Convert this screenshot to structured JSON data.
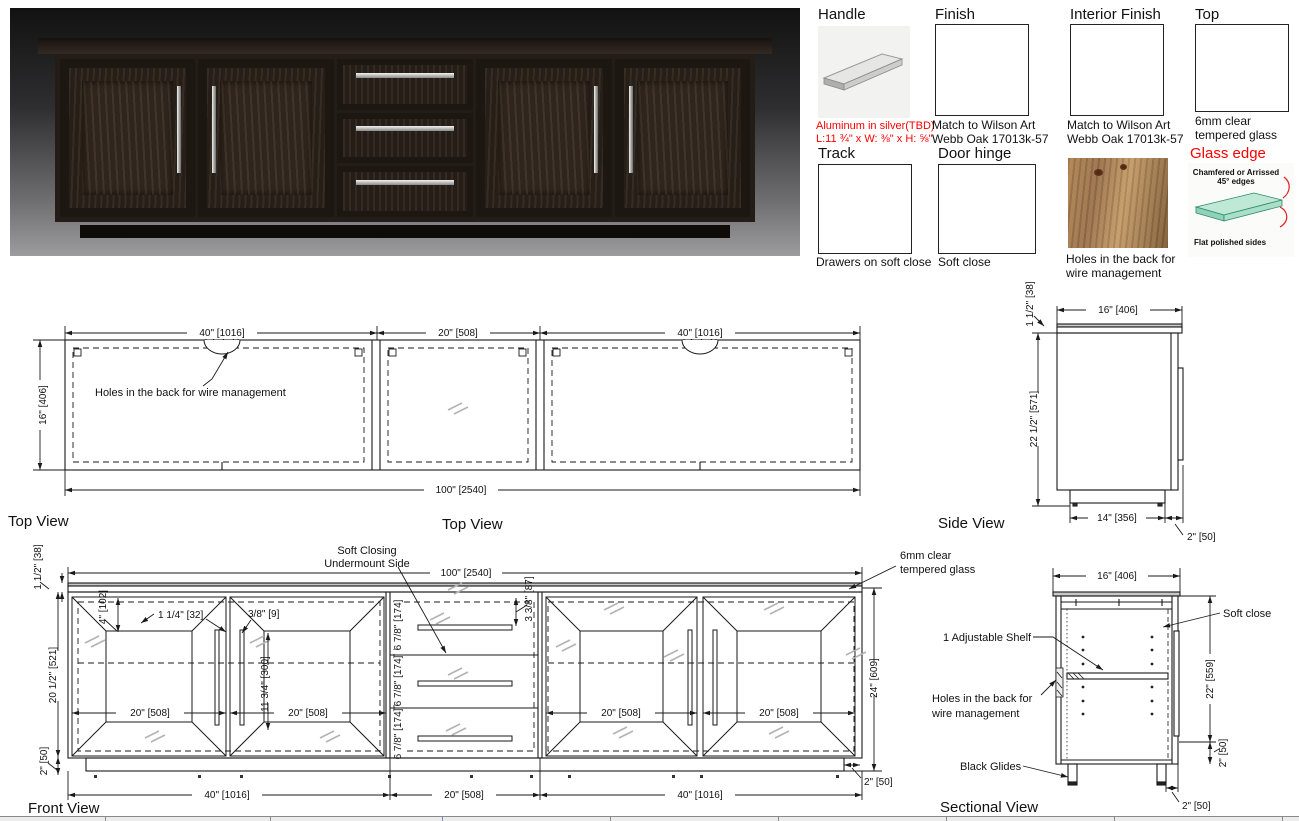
{
  "specs": {
    "handle": {
      "title": "Handle",
      "note1": "Aluminum in silver(TBD)",
      "note2": "L:11 ¾\" x W: ⅜\" x H: ⅝\""
    },
    "finish": {
      "title": "Finish",
      "note1": "Match to Wilson Art",
      "note2": "Webb Oak 17013k-57"
    },
    "interior_finish": {
      "title": "Interior Finish",
      "note1": "Match to Wilson Art",
      "note2": "Webb Oak 17013k-57"
    },
    "top": {
      "title": "Top",
      "note1": "6mm clear",
      "note2": "tempered glass"
    },
    "track": {
      "title": "Track",
      "note": "Drawers on soft close"
    },
    "door_hinge": {
      "title": "Door hinge",
      "note": "Soft close"
    },
    "wire_holes": {
      "note1": "Holes in the back for",
      "note2": "wire management"
    },
    "glass_edge": {
      "title": "Glass edge",
      "label1a": "Chamfered or Arrissed",
      "label1b": "45° edges",
      "label2": "Flat polished sides"
    }
  },
  "top_view": {
    "title_left": "Top View",
    "title_center": "Top View",
    "dim_w_left": "40\" [1016]",
    "dim_w_mid": "20\" [508]",
    "dim_w_right": "40\" [1016]",
    "dim_depth": "16\" [406]",
    "dim_total": "100\" [2540]",
    "note_holes": "Holes in the back for wire management"
  },
  "side_view": {
    "title": "Side View",
    "dim_width": "16\" [406]",
    "dim_top": "1 1/2\" [38]",
    "dim_height": "22 1/2\" [571]",
    "dim_base": "14\" [356]",
    "dim_offset": "2\" [50]"
  },
  "front_view": {
    "title": "Front View",
    "dim_total": "100\" [2540]",
    "dim_top_thickness": "1 1/2\" [38]",
    "dim_frame": "4\" [102]",
    "dim_stile": "1 1/4\" [32]",
    "dim_gap": "3/8\" [9]",
    "dim_panel_h": "11 3/4\" [300]",
    "dim_body_h": "20 1/2\" [521]",
    "dim_kick": "2\" [50]",
    "dim_door_w": "20\" [508]",
    "dim_drawer_h": "6 7/8\" [174]",
    "dim_top_drawer": "3 3/8\" [87]",
    "dim_height": "24\" [609]",
    "dim_kick_inset": "2\" [50]",
    "dim_bottom_left": "40\" [1016]",
    "dim_bottom_mid": "20\" [508]",
    "dim_bottom_right": "40\" [1016]",
    "note_soft1": "Soft Closing",
    "note_soft2": "Undermount Side",
    "note_glass1": "6mm clear",
    "note_glass2": "tempered glass"
  },
  "sectional_view": {
    "title": "Sectional View",
    "dim_width": "16\" [406]",
    "dim_height": "22\" [559]",
    "dim_bottom": "2\" [50]",
    "dim_glide": "2\" [50]",
    "note_soft": "Soft close",
    "note_shelf": "1 Adjustable Shelf",
    "note_holes1": "Holes in the back for",
    "note_holes2": "wire management",
    "note_glides": "Black Glides"
  },
  "colors": {
    "annotation_red": "#ff0000",
    "line": "#1a1a1a",
    "glass_symbol": "#b3b3b3"
  }
}
